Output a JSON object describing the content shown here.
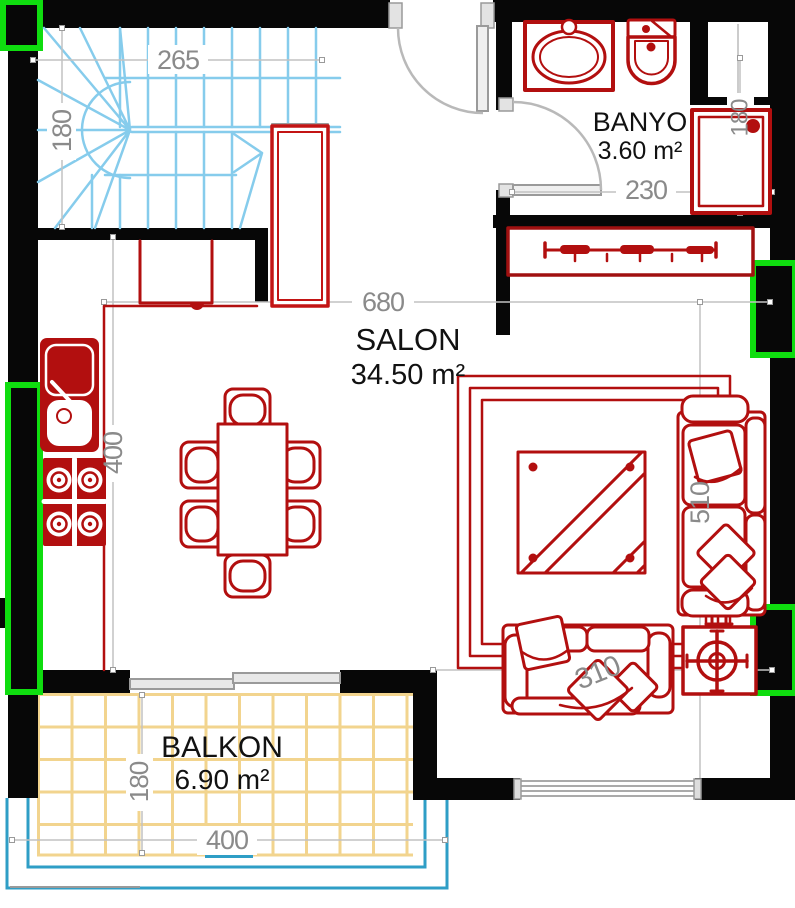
{
  "rooms": {
    "salon": {
      "name": "SALON",
      "area": "34.50 m²"
    },
    "banyo": {
      "name": "BANYO",
      "area": "3.60 m²"
    },
    "balkon": {
      "name": "BALKON",
      "area": "6.90 m²"
    }
  },
  "dimensions": {
    "stair_width": "265",
    "stair_depth": "180",
    "salon_width": "680",
    "kitchen_wall": "400",
    "banyo_width": "230",
    "banyo_depth": "180",
    "salon_depth": "510",
    "sofa_wall": "310",
    "balkon_width": "400",
    "balkon_depth": "180"
  },
  "colors": {
    "wall_black": "#070707",
    "furniture_red": "#b20f0f",
    "stair_cyan": "#86ccec",
    "window_green": "#0fdd0f",
    "balcony_tile": "#f2d48e",
    "railing_blue": "#2f9ec6",
    "door_gray": "#b9b9b9",
    "dimension_gray": "#8a8a8a"
  }
}
